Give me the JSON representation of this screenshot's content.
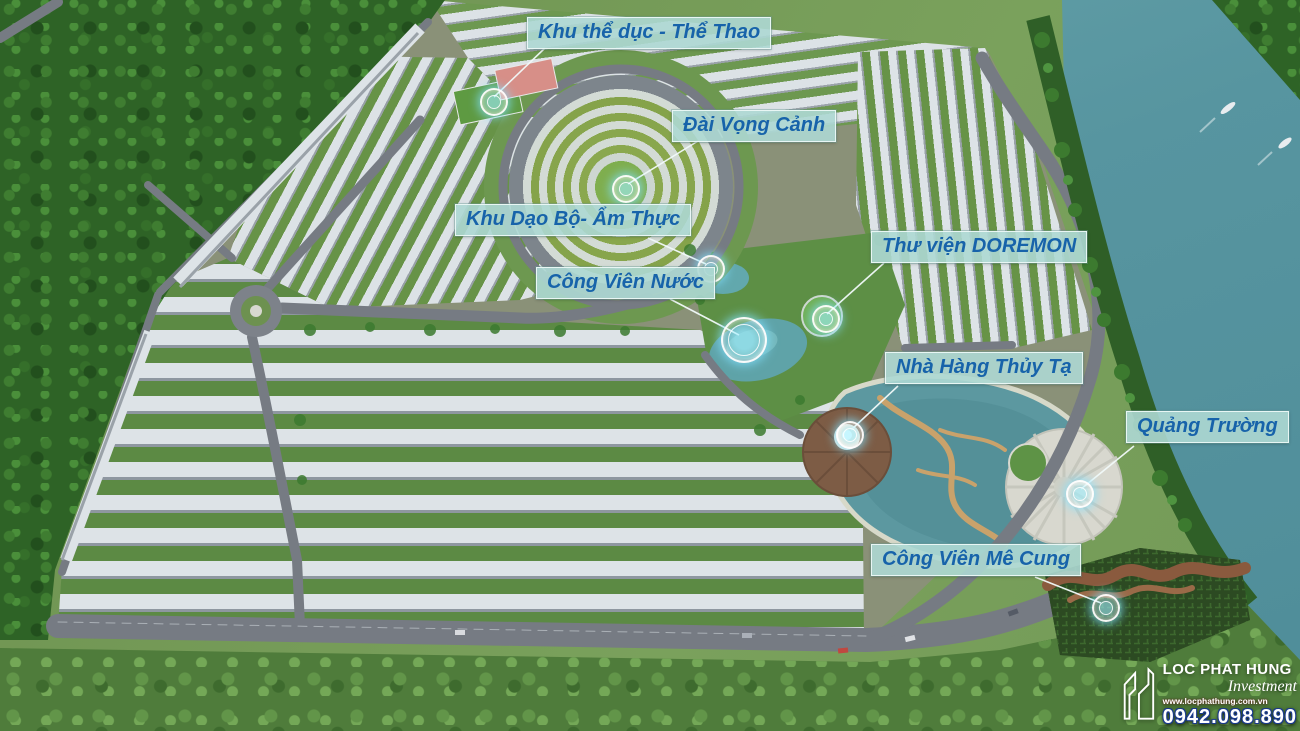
{
  "labels": [
    {
      "id": "sports-area",
      "text": "Khu thể dục - Thể Thao"
    },
    {
      "id": "observation-tower",
      "text": "Đài Vọng Cảnh"
    },
    {
      "id": "walking-food-area",
      "text": "Khu Dạo Bộ- Ẩm Thực"
    },
    {
      "id": "doremon-library",
      "text": "Thư viện DOREMON"
    },
    {
      "id": "water-park",
      "text": "Công Viên Nước"
    },
    {
      "id": "lake-restaurant",
      "text": "Nhà Hàng Thủy Tạ"
    },
    {
      "id": "plaza",
      "text": "Quảng Trường"
    },
    {
      "id": "maze-park",
      "text": "Công Viên Mê Cung"
    }
  ],
  "branding": {
    "company": "LOC PHAT HUNG",
    "division": "Investment",
    "website": "www.locphathung.com.vn",
    "phone": "0942.098.890"
  },
  "colors": {
    "label_bg": "#add8d3",
    "label_text": "#1763aa",
    "river": "#5795a0",
    "forest": "#2e6326",
    "roofs": "#dde3e7",
    "road": "#767b83",
    "marker_glow": "#7fd8ff"
  }
}
